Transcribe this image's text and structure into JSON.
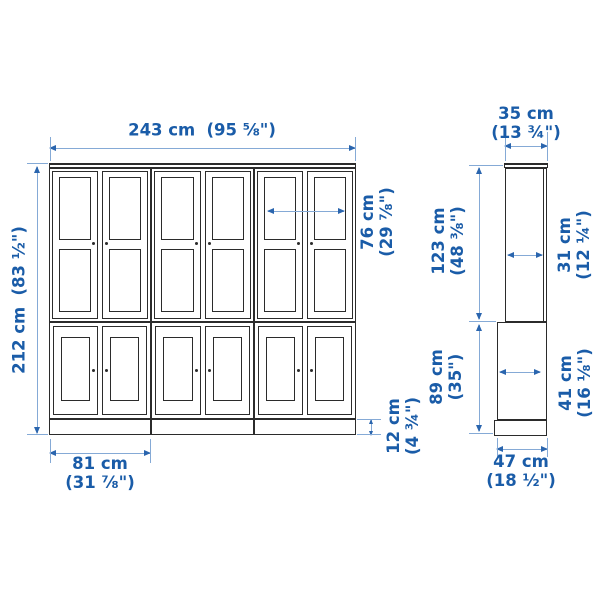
{
  "colors": {
    "bg": "#ffffff",
    "ink": "#1a5ca8",
    "line": "#85aad6",
    "arrow": "#2a65ae",
    "cabinet": "#2b2b2b"
  },
  "front_view": {
    "dimensions": {
      "total_width": {
        "metric": "243 cm",
        "imperial": "(95 ⅝\")"
      },
      "total_height": {
        "metric": "212 cm",
        "imperial": "(83 ½\")"
      },
      "door_width": {
        "metric": "76 cm",
        "imperial": "(29 ⅞\")"
      },
      "plinth_height": {
        "metric": "12 cm",
        "imperial": "(4 ¾\")"
      },
      "unit_width": {
        "metric": "81 cm",
        "imperial": "(31 ⅞\")"
      }
    }
  },
  "side_view": {
    "dimensions": {
      "top_depth": {
        "metric": "35 cm",
        "imperial": "(13 ¾\")"
      },
      "upper_height": {
        "metric": "123 cm",
        "imperial": "(48 ⅜\")"
      },
      "lower_height": {
        "metric": "89 cm",
        "imperial": "(35\")"
      },
      "upper_depth": {
        "metric": "31 cm",
        "imperial": "(12 ¼\")"
      },
      "lower_depth": {
        "metric": "41 cm",
        "imperial": "(16 ⅛\")"
      },
      "base_depth": {
        "metric": "47 cm",
        "imperial": "(18 ½\")"
      }
    }
  }
}
